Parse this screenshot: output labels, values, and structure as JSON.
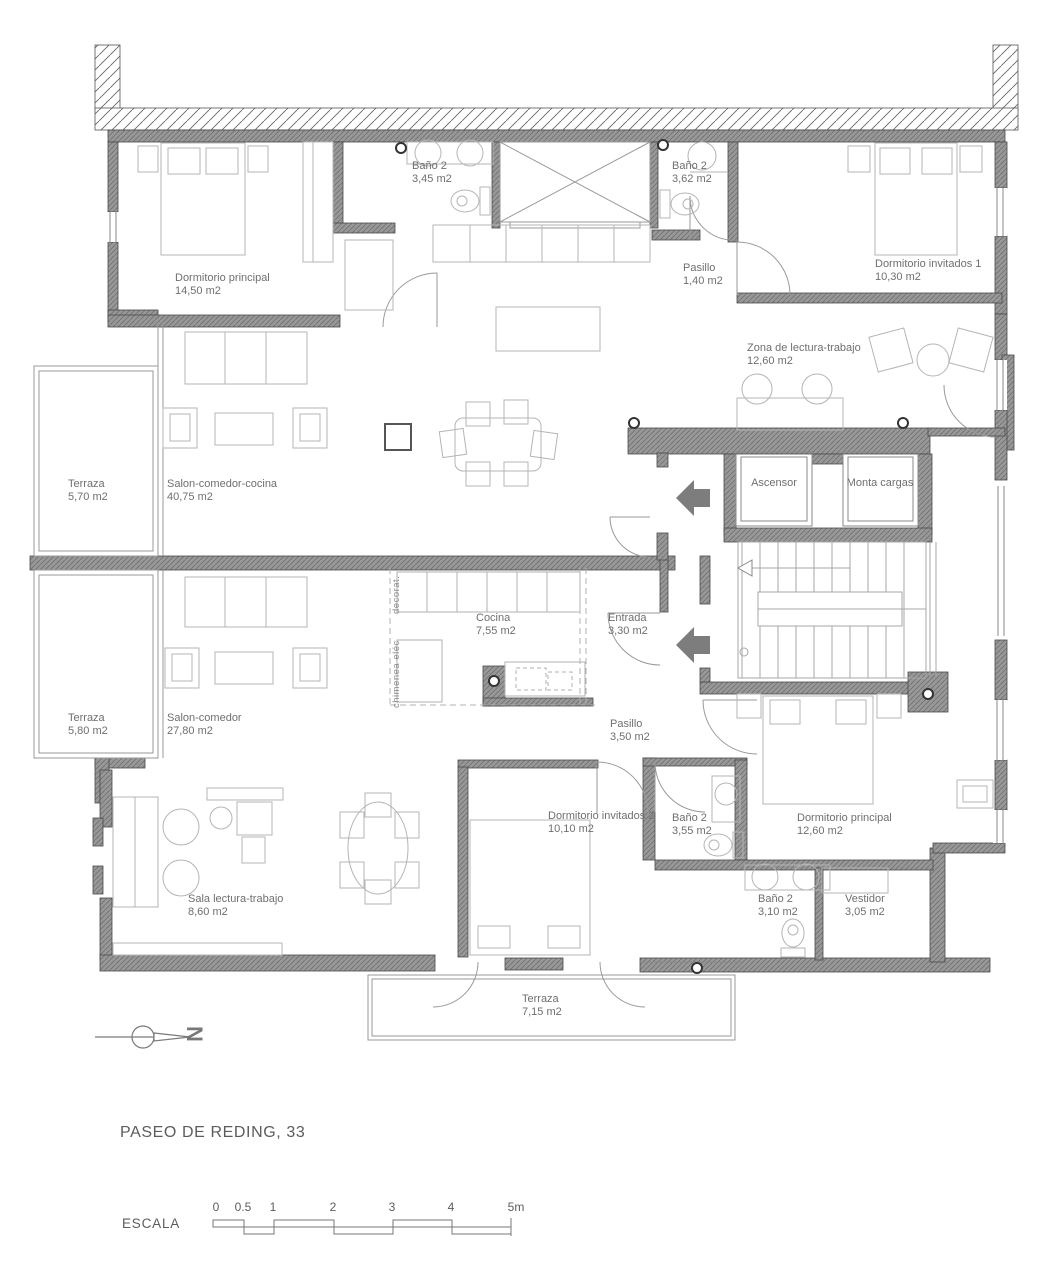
{
  "plan": {
    "title": "PASEO DE REDING, 33",
    "north_label": "N",
    "scale": {
      "label": "ESCALA",
      "ticks": [
        "0",
        "0.5",
        "1",
        "2",
        "3",
        "4",
        "5m"
      ]
    },
    "rooms": [
      {
        "name": "Dormitorio principal",
        "area": "14,50 m2"
      },
      {
        "name": "Baño 2",
        "area": "3,45 m2"
      },
      {
        "name": "Baño 2",
        "area": "3,62 m2"
      },
      {
        "name": "Pasillo",
        "area": "1,40 m2"
      },
      {
        "name": "Dormitorio invitados 1",
        "area": "10,30 m2"
      },
      {
        "name": "Zona de lectura-trabajo",
        "area": "12,60 m2"
      },
      {
        "name": "Ascensor",
        "area": ""
      },
      {
        "name": "Monta cargas",
        "area": ""
      },
      {
        "name": "Terraza",
        "area": "5,70 m2"
      },
      {
        "name": "Salon-comedor-cocina",
        "area": "40,75 m2"
      },
      {
        "name": "Cocina",
        "area": "7,55 m2"
      },
      {
        "name": "Entrada",
        "area": "3,30 m2"
      },
      {
        "name": "Terraza",
        "area": "5,80 m2"
      },
      {
        "name": "Salon-comedor",
        "area": "27,80 m2"
      },
      {
        "name": "Pasillo",
        "area": "3,50 m2"
      },
      {
        "name": "Dormitorio invitados 2",
        "area": "10,10 m2"
      },
      {
        "name": "Baño 2",
        "area": "3,55 m2"
      },
      {
        "name": "Dormitorio principal",
        "area": "12,60 m2"
      },
      {
        "name": "Sala lectura-trabajo",
        "area": "8,60 m2"
      },
      {
        "name": "Baño 2",
        "area": "3,10 m2"
      },
      {
        "name": "Vestidor",
        "area": "3,05 m2"
      },
      {
        "name": "Terraza",
        "area": "7,15 m2"
      }
    ],
    "annotations": [
      {
        "text": "decorat."
      },
      {
        "text": "chimenea eléc"
      }
    ],
    "colors": {
      "wall": "#8f8f8f",
      "wall_hatch": "#6f6f6f",
      "thin_line": "#8a8a8a",
      "furniture": "#b5b5b5",
      "text": "#6f6f6f"
    }
  }
}
